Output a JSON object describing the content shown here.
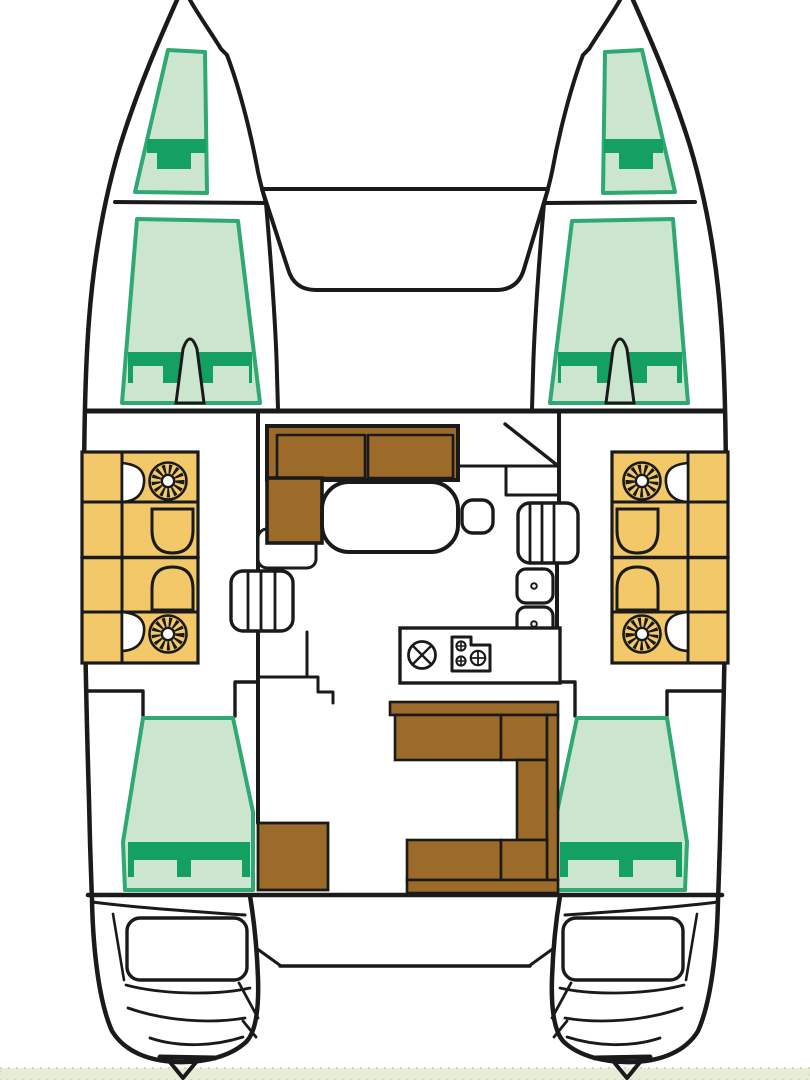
{
  "diagram": {
    "kind": "catamaran-deck-plan",
    "orientation": "bow-up",
    "regions": [
      "forepeak-berth-port",
      "forepeak-berth-starboard",
      "forward-cabin-port",
      "forward-cabin-starboard",
      "bathroom-block-port",
      "bathroom-block-starboard",
      "saloon-sofa",
      "saloon-table",
      "galley",
      "companionway-steps",
      "cockpit-bench",
      "aft-cabin-port",
      "aft-cabin-starboard",
      "transom-port",
      "transom-starboard"
    ]
  },
  "colors": {
    "line": "#1a1a1a",
    "hull_fill": "#ffffff",
    "bed_light": "#cbe5cf",
    "bed_border": "#2fa874",
    "bed_pillow": "#13a061",
    "bath_yellow": "#f3c869",
    "wood_brown": "#9c6b2a",
    "strip": "#e7ecd6",
    "strip_dot": "#cfdcb4"
  }
}
